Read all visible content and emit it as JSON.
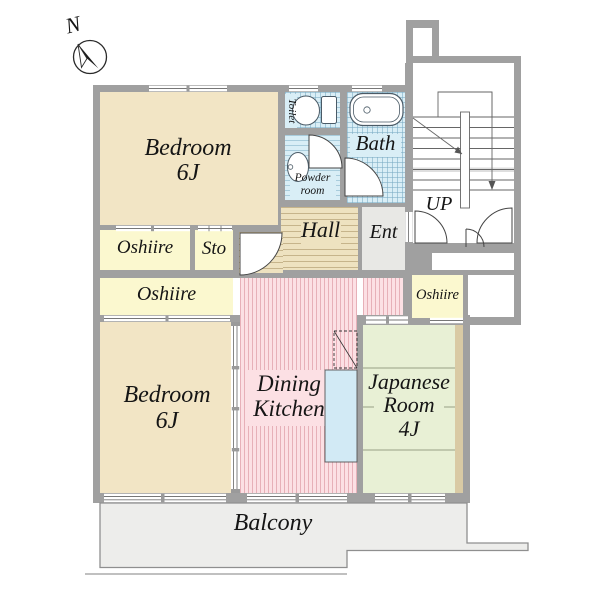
{
  "plan": {
    "compass_north": "N",
    "stairs_up": "UP",
    "balcony": "Balcony",
    "bedroom_top": {
      "name": "Bedroom",
      "size": "6J"
    },
    "bedroom_bottom": {
      "name": "Bedroom",
      "size": "6J"
    },
    "dining_kitchen": {
      "line1": "Dining",
      "line2": "Kitchen"
    },
    "japanese_room": {
      "line1": "Japanese",
      "line2": "Room",
      "size": "4J"
    },
    "bath": "Bath",
    "toilet": "Toilet",
    "powder_room": {
      "line1": "Powder",
      "line2": "room"
    },
    "hall": "Hall",
    "entrance": "Ent",
    "storage": "Sto",
    "oshiire_top": "Oshiire",
    "oshiire_middle": "Oshiire",
    "oshiire_right": "Oshiire"
  },
  "colors": {
    "wall": "#a0a0a0",
    "bedroom": "#f2e5c5",
    "closet": "#fbf8cf",
    "tatami_room": "#e8f0d5",
    "wet_area_tile": "#d9eef6",
    "hall_wood": "#eee2c0",
    "dining_kitchen": "#fce0e4",
    "entrance": "#e8e8e5",
    "balcony": "#ededeb",
    "kitchen_counter": "#d2eaf5",
    "text": "#151515"
  }
}
